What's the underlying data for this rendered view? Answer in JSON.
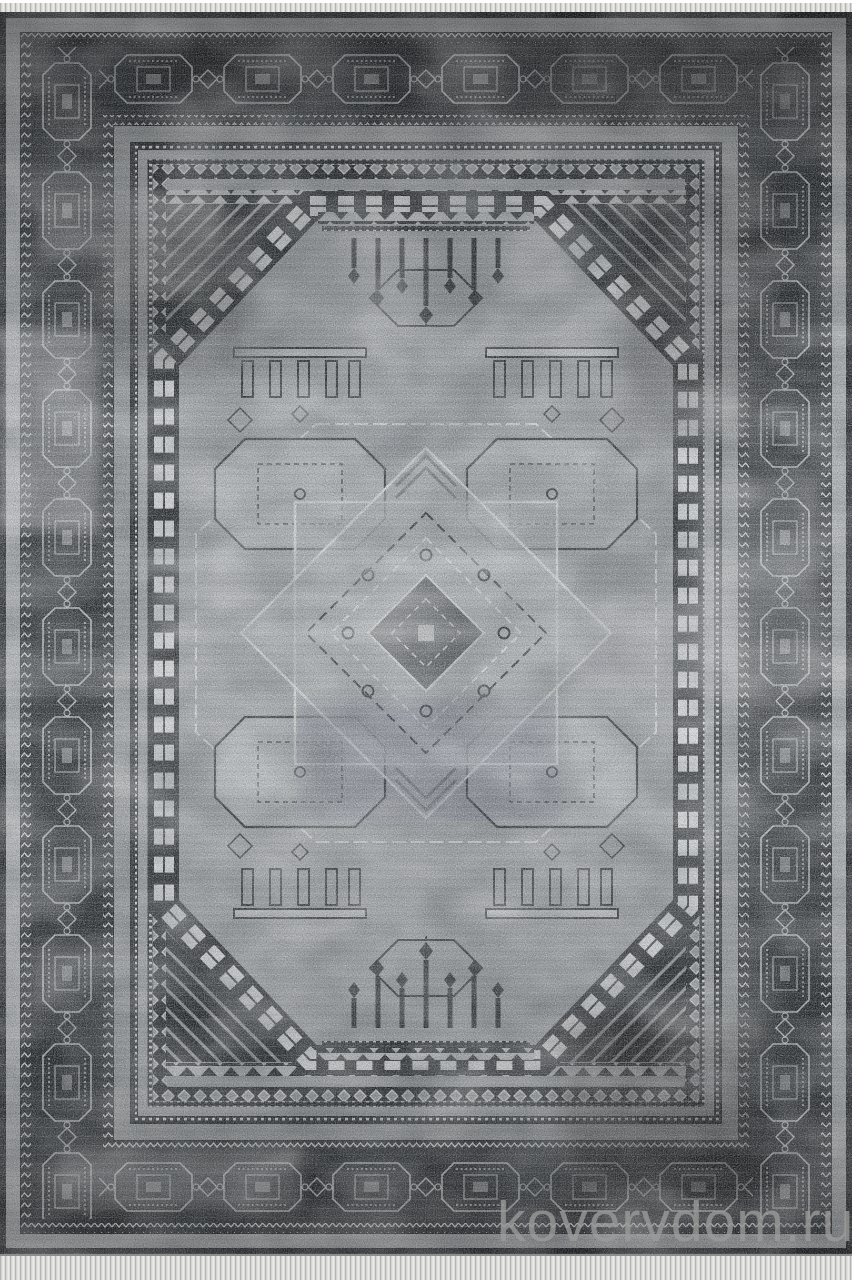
{
  "watermark": {
    "text": "kovervdom.ru"
  },
  "palette": {
    "fringe": "#dcdcda",
    "fringe_shadow": "#b4b4b2",
    "edge_black": "#131518",
    "stripe": "#a6a9ab",
    "stripe2": "#8f9294",
    "band_dark": "#1e2124",
    "band_light": "#b7babc",
    "field": "#9a9da0",
    "field2": "#96999c",
    "field3": "#a6a9ab",
    "ink": "#26292c",
    "light": "#d3d5d7",
    "wm": "#9b9b9b"
  }
}
